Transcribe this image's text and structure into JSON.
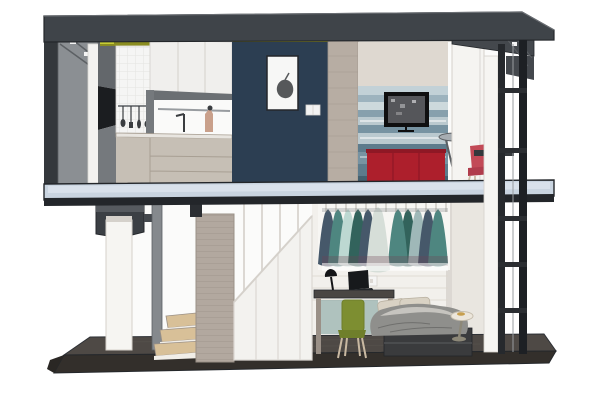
{
  "scene": {
    "type": "architectural-cutaway-section-render",
    "floors": [
      {
        "name": "upper-floor",
        "areas": [
          {
            "name": "kitchen",
            "objects": [
              "upper-cabinets",
              "tile-backsplash",
              "hanging-utensils",
              "hood-shelf",
              "faucet",
              "countertop",
              "base-cabinets"
            ]
          },
          {
            "name": "living-room",
            "objects": [
              "navy-accent-wall",
              "framed-artwork",
              "light-switch",
              "watercolor-mural-wall",
              "tv",
              "red-sideboard",
              "round-side-table",
              "red-chair",
              "door-panel"
            ]
          }
        ]
      },
      {
        "name": "lower-floor",
        "areas": [
          {
            "name": "stair-area",
            "objects": [
              "winder-steps",
              "stair-column",
              "under-stair-wardrobe",
              "stair-railing"
            ]
          },
          {
            "name": "bedroom",
            "objects": [
              "clothes-rail",
              "hanging-clothes",
              "wall-outlet",
              "desk",
              "desk-lamp",
              "laptop",
              "green-chair",
              "bed",
              "bedside-stool"
            ]
          }
        ]
      }
    ],
    "structure": [
      "roof-slab",
      "left-cut-wall",
      "ceiling-light-strip",
      "mid-floor-slab",
      "base-platform",
      "right-frame-ladder"
    ]
  },
  "colors": {
    "bg": "#ffffff",
    "line": "#2e3136",
    "roomBg": "#fbfbfa",
    "roof": "#3f4449",
    "roofEdge": "#24272b",
    "roofUnder": "#43474b",
    "leftWallDark": "#34383c",
    "leftWallGray": "#8b8f93",
    "leftWallLight": "#f3f2f0",
    "braceLine": "#5c6064",
    "recessBlack": "#1b1d20",
    "blockGray": "#63676b",
    "lowerGray": "#75797d",
    "oliveBright": "#c6cc35",
    "olive": "#8b8d20",
    "tile": "#f5f5f4",
    "tileLine": "#e3e3e1",
    "cabinet": "#f0efed",
    "cabinetSeam": "#d9d6d2",
    "hood": "#6b6f73",
    "innerWall": "#fafaf9",
    "steel": "#3a3d40",
    "figure": "#c9a08b",
    "counter": "#e8e5e0",
    "baseCab": "#c6bfb5",
    "baseCabLine": "#a89f93",
    "navy": "#2c3e52",
    "artPaper": "#f7f7f6",
    "artInk": "#56585a",
    "switch": "#f2f2f2",
    "beigeCol": "#b7ada3",
    "beigeColLine": "#a0968c",
    "ceiling": "#cfccc6",
    "wallBeige": "#ded8d0",
    "mural1": "#c2d1d7",
    "mural2": "#9db3be",
    "mural3": "#cdd9dc",
    "mural4": "#87a0ad",
    "mural5": "#bac9cf",
    "mural6": "#7793a2",
    "mural7": "#5d7b8c",
    "mural8": "#44606f",
    "tvFrame": "#0f0f10",
    "tvScreen": "#55565a",
    "red": "#ad1f2c",
    "redDark": "#8f1825",
    "tableTop": "#a7adb2",
    "legGray": "#5b5f63",
    "door": "#f5f4f1",
    "overhang": "#44484d",
    "post": "#26292d",
    "postDark": "#1d2024",
    "rung": "#2b2e32",
    "cable": "#989ca0",
    "chairRed": "#c24a57",
    "chairRedDark": "#b03c4c",
    "legTan": "#c9b9a2",
    "slab": "#c9d4e0",
    "slabLight": "#dfe7ef",
    "slabDark": "#23262a",
    "bracket": "#3b3f44",
    "bracketTop": "#565a5f",
    "panelWhite": "#f6f5f2",
    "panelEdge": "#d5d1cb",
    "postGray": "#85898d",
    "stepWood": "#d8c098",
    "stepSide": "#f1eee8",
    "stairCol": "#b2a89f",
    "stairColLine": "#9a9087",
    "wardrobe": "#f3f2ef",
    "seam": "#dcd8d3",
    "railLine": "#8e9297",
    "hanger": "#b9b4ad",
    "g1": "#46586a",
    "g2": "#4e8680",
    "g3": "#bdd8d2",
    "g4": "#32635c",
    "g5": "#d6ded8",
    "g6": "#9fb8b8",
    "plum": "#6f4254",
    "backWall": "#f2f0ec",
    "clothesBack": "#f7f6f3",
    "plank": "#dcd6cd",
    "outlet": "#f5f5f4",
    "mirror": "#6b9490",
    "desk": "#4a4643",
    "lamp": "#141517",
    "laptop": "#17191c",
    "laptopBase": "#23262a",
    "chairGreen": "#7d8e31",
    "chairGreenDark": "#6f7f2b",
    "bedBase": "#3a3b3d",
    "bedSeam": "#55565a",
    "duvet": "#8f8f8c",
    "duvetLight": "#c6c4bf",
    "pillow": "#d9d2c4",
    "pillowLine": "#b8b0a0",
    "stoolTop": "#ece6db",
    "stoolEdge": "#c6beae",
    "gold": "#c79f4e",
    "stoolLeg": "#8d8878",
    "zone": "#e9e6e0",
    "platformTop": "#4e4945",
    "platformFace": "#332f2b",
    "platformDark": "#2a2724"
  }
}
